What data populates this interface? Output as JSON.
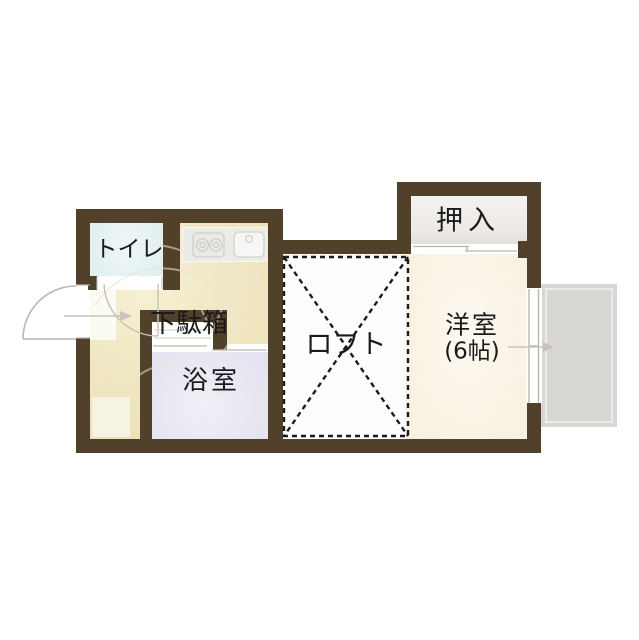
{
  "plan": {
    "type": "japanese-apartment-floor-plan",
    "rooms": {
      "toilet": {
        "label": "トイレ"
      },
      "shoe_cabinet": {
        "label": "下駄箱"
      },
      "bathroom": {
        "label": "浴室"
      },
      "loft": {
        "label": "ロフト"
      },
      "closet": {
        "label": "押入"
      },
      "western_room": {
        "label": "洋室",
        "size": "(6帖)"
      }
    },
    "colors": {
      "wall": "#51412b",
      "hall_kitchen_floor": "#efe5c0",
      "toilet_floor": "#dfeef0",
      "bath_floor": "#e3e1ee",
      "western_room_floor": "#f8f0df",
      "closet_floor": "#ece9e6",
      "loft_floor": "#fdfdfd",
      "balcony": "#d8d7d4",
      "kitchen_counter": "#ebebe8",
      "loft_dash": "#1c1c1c",
      "label_text": "#1b1b1b"
    },
    "icons": [
      "stove-icon",
      "sink-icon",
      "entrance-door-arc-icon",
      "toilet-door-arc-icon",
      "sliding-door-icon",
      "window-icon",
      "entry-arrow-icon",
      "balcony-arrow-icon"
    ]
  }
}
